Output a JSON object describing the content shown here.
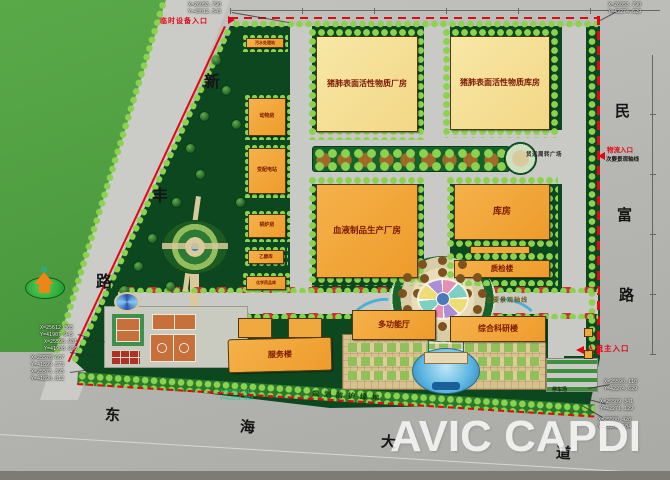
{
  "watermark": "AVIC CAPDI",
  "compass": {
    "label": "N"
  },
  "roads": {
    "xinfeng": {
      "chars": [
        "新",
        "丰",
        "路"
      ]
    },
    "minfu": {
      "chars": [
        "民",
        "富",
        "路"
      ]
    },
    "donghai": {
      "chars": [
        "东",
        "海",
        "大",
        "道"
      ]
    }
  },
  "buildings": {
    "surfactant_plant": "猪肺表面活性物质厂房",
    "surfactant_warehouse": "猪肺表面活性物质库房",
    "blood_products_plant": "血液制品生产厂房",
    "warehouse": "库房",
    "qc_building": "质检楼",
    "service_building": "服务楼",
    "multifunction_hall": "多功能厅",
    "research_building": "综合科研楼",
    "sewage_station": "污水处理站",
    "animal_house": "动物房",
    "substation": "变配电站",
    "boiler_room": "锅炉房",
    "ethanol_storage": "乙醇库",
    "chemical_storage": "化学药品库"
  },
  "entrances": {
    "temp_equipment": "临时设备入口",
    "logistics": "物流入口",
    "pedestrian_main": "人流主入口"
  },
  "labels": {
    "freight_plaza": "货运周转广场",
    "main_axis": "主要景观轴线",
    "secondary_axis": "次要景观轴线",
    "parking": "停车场",
    "protective_green": "规划防护绿地"
  },
  "coordinates": {
    "top_left": {
      "x": "X=26053.790",
      "y": "Y=43012.543"
    },
    "top_right": {
      "x": "X=26053.790",
      "y": "Y=42274.629"
    },
    "east_1": {
      "x": "X=25590.110",
      "y": "Y=42274.629"
    },
    "east_2": {
      "x": "X=25509.341",
      "y": "Y=42271.129"
    },
    "east_3": {
      "x": "X=25500.420",
      "y": "Y=42269.504"
    },
    "west_1": {
      "x": "X=25612.365",
      "y": "Y=41907.945"
    },
    "west_2": {
      "x": "X=25598.981",
      "y": "Y=41908.956"
    },
    "west_3": {
      "x": "X=25576.667",
      "y": "Y=41899.573"
    },
    "west_4": {
      "x": "X=25573.395",
      "y": "Y=41898.812"
    },
    "south_center": {
      "x": "X=25547.013",
      "y": "Y=42052.893"
    }
  },
  "colors": {
    "site_green": "#0d4720",
    "park_green": "#4f9e41",
    "road_gray": "#c9c9c5",
    "building_orange": "#f0a93e",
    "building_pale": "#f7e3a0",
    "boundary_red": "#e30613",
    "water_blue": "#5fc0e8",
    "bush_green": "#8bd24f"
  }
}
